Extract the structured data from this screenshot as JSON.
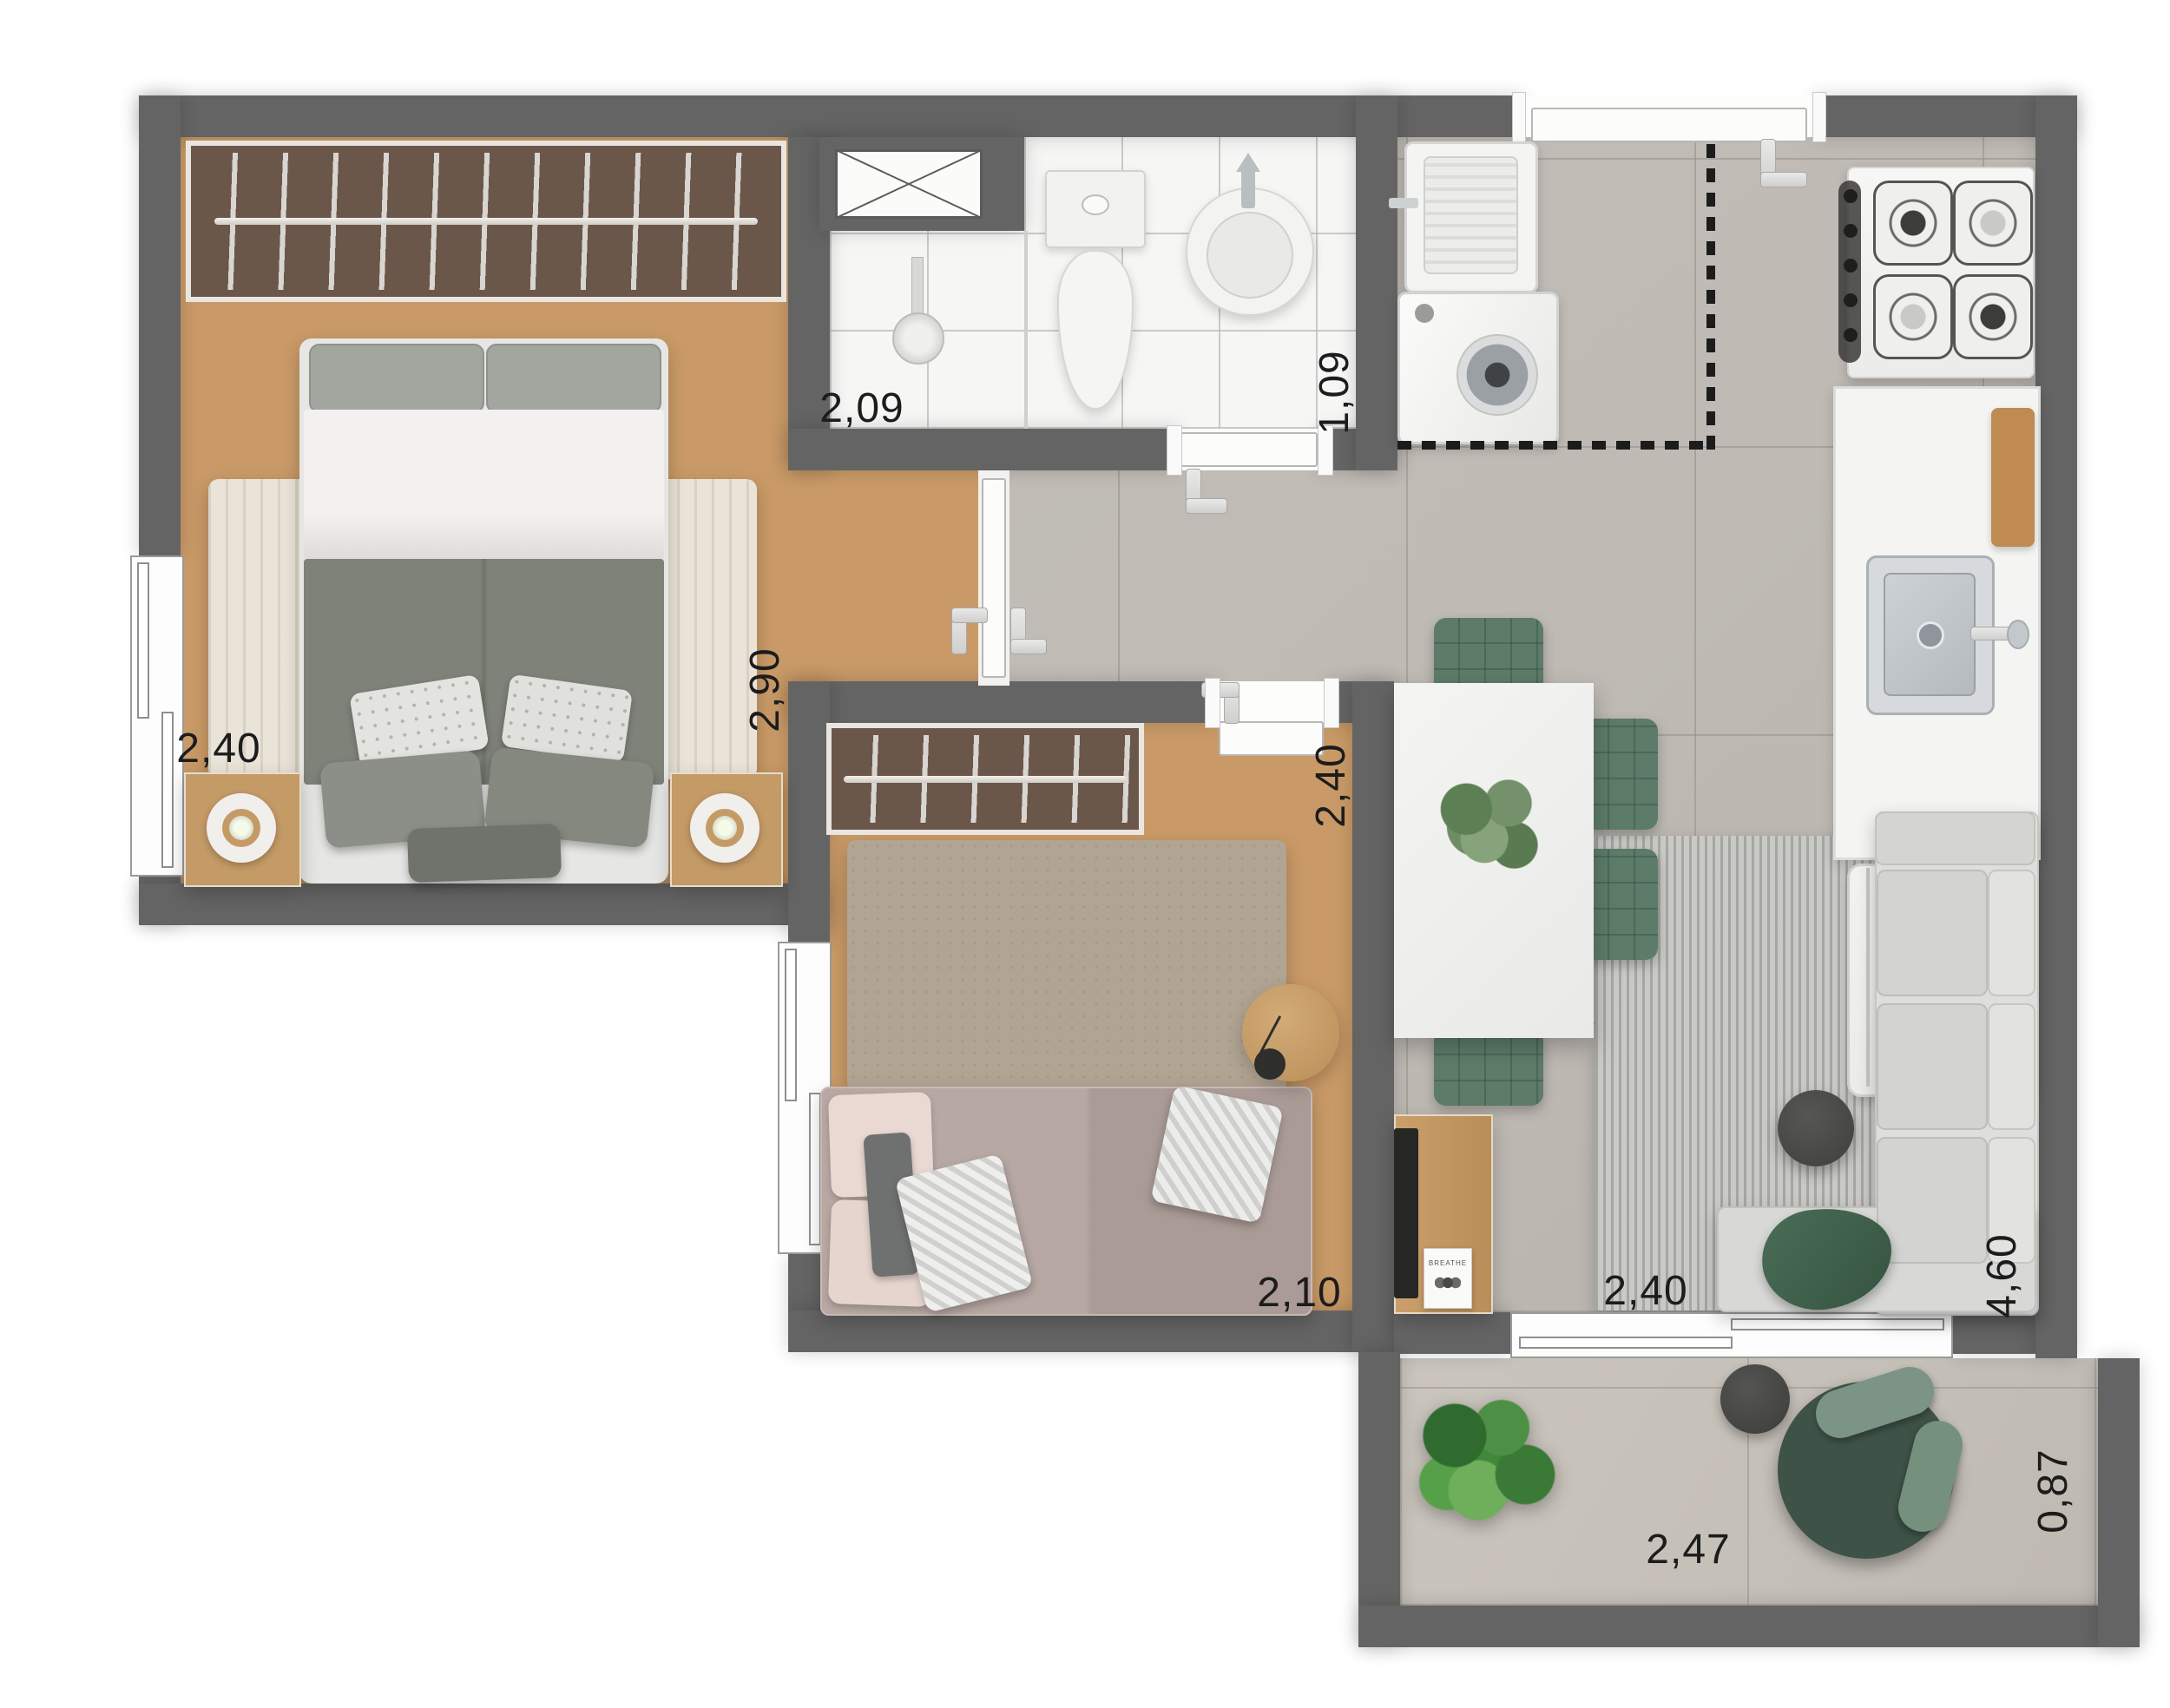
{
  "plan": {
    "type": "apartment-floor-plan",
    "rooms": {
      "bedroom1": {
        "width": "2,40",
        "depth": "2,90"
      },
      "bathroom": {
        "width": "2,09",
        "depth": "1,09"
      },
      "bedroom2": {
        "width": "2,10",
        "depth": "2,40"
      },
      "living": {
        "width": "2,40",
        "depth": "4,60"
      },
      "balcony": {
        "width": "2,47",
        "depth": "0,87"
      }
    },
    "decor": {
      "book_title": "BREATHE"
    },
    "colors": {
      "wall": "#646464",
      "wood_floor": "#c99a67",
      "tile_floor": "#bfbab4",
      "bathroom_tile": "#f6f6f5",
      "closet": "#6b564a",
      "accent_green": "#5d7b69",
      "rug_cream": "#eae4d8",
      "rug_beige": "#b2a492",
      "rug_gray": "#c9c9c5",
      "throw_green": "#41634f"
    }
  }
}
